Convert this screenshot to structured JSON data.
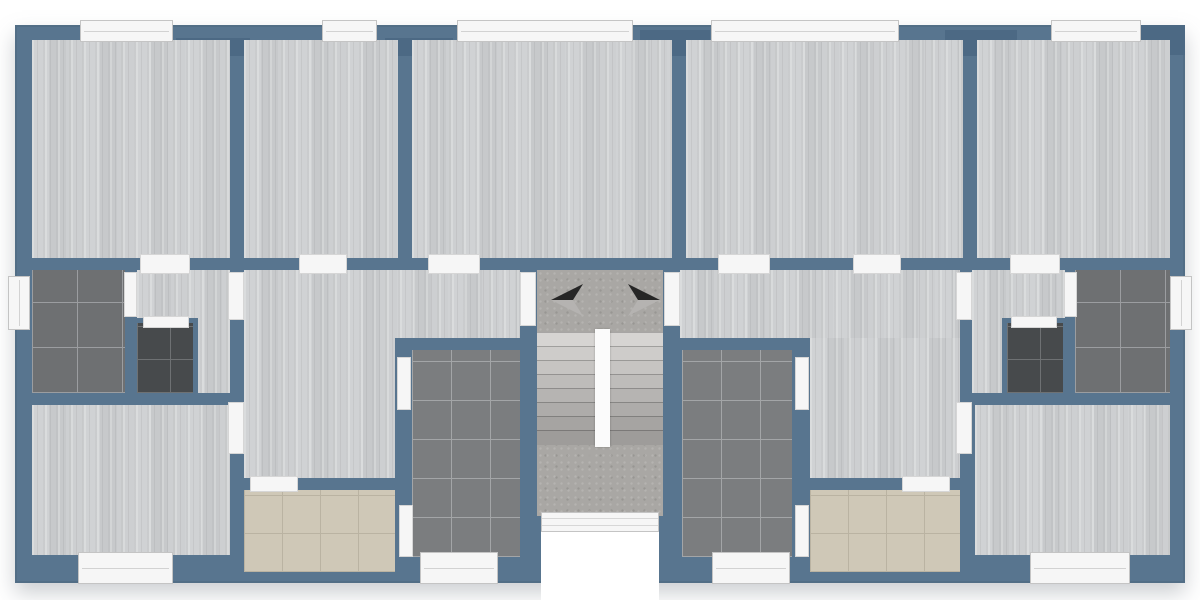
{
  "canvas": {
    "width": 1200,
    "height": 600
  },
  "palette": {
    "outside": "#ffffff",
    "wall": "#58758f",
    "wall_dark": "#4c6984",
    "wood": "#cbcdcf",
    "concrete": "#a9a7a4",
    "tile_gray": "#7b7d7f",
    "tile_gray_grout": "#a3a5a7",
    "tile_gray2": "#6e7072",
    "tile_gray2_grout": "#9b9da0",
    "tile_dark": "#474a4c",
    "tile_dark_grout": "#6e7173",
    "tile_beige": "#cfc8b7",
    "tile_beige_grout": "#bab3a2",
    "fixture": "#f6f6f6",
    "fixture_border": "#c4c4c4",
    "divider": "#fbfbfb",
    "arrow_dark": "#262626",
    "arrow_light": "#b5b3b1"
  },
  "building": {
    "name": "building-outline",
    "x": 15,
    "y": 25,
    "w": 1170,
    "h": 558
  },
  "floors": [
    {
      "name": "room-top-1-floor",
      "type": "wood",
      "x": 32,
      "y": 40,
      "w": 198,
      "h": 218
    },
    {
      "name": "room-top-2-floor",
      "type": "wood",
      "x": 244,
      "y": 40,
      "w": 154,
      "h": 218
    },
    {
      "name": "room-top-3-floor",
      "type": "wood",
      "x": 412,
      "y": 40,
      "w": 260,
      "h": 218
    },
    {
      "name": "room-top-4-floor",
      "type": "wood",
      "x": 686,
      "y": 40,
      "w": 277,
      "h": 218
    },
    {
      "name": "room-top-5-floor",
      "type": "wood",
      "x": 977,
      "y": 40,
      "w": 193,
      "h": 218
    },
    {
      "name": "bathroom-left-floor",
      "type": "tile-gray2",
      "x": 32,
      "y": 270,
      "w": 93,
      "h": 123
    },
    {
      "name": "corridor-left-floor",
      "type": "wood",
      "x": 137,
      "y": 270,
      "w": 93,
      "h": 123
    },
    {
      "name": "wc-left-floor",
      "type": "tile-dark",
      "x": 132,
      "y": 318,
      "w": 66,
      "h": 80
    },
    {
      "name": "room-bottom-left-floor",
      "type": "wood",
      "x": 32,
      "y": 405,
      "w": 198,
      "h": 150
    },
    {
      "name": "hall-left-upper-floor",
      "type": "wood",
      "x": 244,
      "y": 270,
      "w": 276,
      "h": 68
    },
    {
      "name": "hall-left-lower-floor",
      "type": "wood",
      "x": 244,
      "y": 338,
      "w": 151,
      "h": 140
    },
    {
      "name": "kitchen-left-floor",
      "type": "tile-beige",
      "x": 244,
      "y": 490,
      "w": 151,
      "h": 82
    },
    {
      "name": "bathroom-center-left-floor",
      "type": "tile-gray",
      "x": 412,
      "y": 350,
      "w": 108,
      "h": 207
    },
    {
      "name": "stairwell-floor",
      "type": "concrete",
      "x": 537,
      "y": 270,
      "w": 126,
      "h": 246
    },
    {
      "name": "hall-right-upper-floor",
      "type": "wood",
      "x": 680,
      "y": 270,
      "w": 280,
      "h": 68
    },
    {
      "name": "hall-right-lower-floor",
      "type": "wood",
      "x": 810,
      "y": 338,
      "w": 150,
      "h": 140
    },
    {
      "name": "bathroom-center-right-floor",
      "type": "tile-gray",
      "x": 682,
      "y": 350,
      "w": 110,
      "h": 207
    },
    {
      "name": "kitchen-right-floor",
      "type": "tile-beige",
      "x": 810,
      "y": 490,
      "w": 150,
      "h": 82
    },
    {
      "name": "corridor-right-floor",
      "type": "wood",
      "x": 972,
      "y": 270,
      "w": 93,
      "h": 123
    },
    {
      "name": "wc-right-floor",
      "type": "tile-dark",
      "x": 1002,
      "y": 318,
      "w": 66,
      "h": 80
    },
    {
      "name": "bathroom-right-floor",
      "type": "tile-gray2",
      "x": 1075,
      "y": 270,
      "w": 95,
      "h": 123
    },
    {
      "name": "room-bottom-right-floor",
      "type": "wood",
      "x": 975,
      "y": 405,
      "w": 195,
      "h": 150
    }
  ],
  "windows": [
    {
      "name": "window-top-1",
      "orient": "h",
      "x": 80,
      "y": 20,
      "w": 93,
      "h": 22
    },
    {
      "name": "window-top-2",
      "orient": "h",
      "x": 322,
      "y": 20,
      "w": 55,
      "h": 22
    },
    {
      "name": "window-top-3",
      "orient": "h",
      "x": 457,
      "y": 20,
      "w": 176,
      "h": 22
    },
    {
      "name": "window-top-4",
      "orient": "h",
      "x": 711,
      "y": 20,
      "w": 188,
      "h": 22
    },
    {
      "name": "window-top-5",
      "orient": "h",
      "x": 1051,
      "y": 20,
      "w": 90,
      "h": 22
    },
    {
      "name": "window-left-bathroom",
      "orient": "v",
      "x": 8,
      "y": 276,
      "w": 22,
      "h": 54
    },
    {
      "name": "window-right-bathroom",
      "orient": "v",
      "x": 1170,
      "y": 276,
      "w": 22,
      "h": 54
    },
    {
      "name": "window-bottom-room-left",
      "orient": "h",
      "x": 78,
      "y": 552,
      "w": 95,
      "h": 32
    },
    {
      "name": "window-bottom-bath-center-left",
      "orient": "h",
      "x": 420,
      "y": 552,
      "w": 78,
      "h": 32
    },
    {
      "name": "window-bottom-bath-center-right",
      "orient": "h",
      "x": 712,
      "y": 552,
      "w": 78,
      "h": 32
    },
    {
      "name": "window-bottom-room-right",
      "orient": "h",
      "x": 1030,
      "y": 552,
      "w": 100,
      "h": 32
    }
  ],
  "doors": [
    {
      "name": "opening-room-top-1",
      "x": 140,
      "y": 254,
      "w": 50,
      "h": 20
    },
    {
      "name": "opening-room-top-2",
      "x": 299,
      "y": 254,
      "w": 48,
      "h": 20
    },
    {
      "name": "opening-room-top-3",
      "x": 428,
      "y": 254,
      "w": 52,
      "h": 20
    },
    {
      "name": "opening-room-top-4",
      "x": 718,
      "y": 254,
      "w": 52,
      "h": 20
    },
    {
      "name": "opening-room-top-5",
      "x": 853,
      "y": 254,
      "w": 48,
      "h": 20
    },
    {
      "name": "opening-room-top-6",
      "x": 1010,
      "y": 254,
      "w": 50,
      "h": 20
    },
    {
      "name": "door-apartment-left",
      "x": 520,
      "y": 272,
      "w": 16,
      "h": 54
    },
    {
      "name": "door-apartment-right",
      "x": 664,
      "y": 272,
      "w": 16,
      "h": 54
    },
    {
      "name": "door-corridor-left",
      "x": 228,
      "y": 272,
      "w": 16,
      "h": 48
    },
    {
      "name": "door-room-bottom-left",
      "x": 228,
      "y": 402,
      "w": 16,
      "h": 52
    },
    {
      "name": "door-corridor-right",
      "x": 956,
      "y": 272,
      "w": 16,
      "h": 48
    },
    {
      "name": "door-room-bottom-right",
      "x": 956,
      "y": 402,
      "w": 16,
      "h": 52
    },
    {
      "name": "door-bathroom-left",
      "x": 124,
      "y": 272,
      "w": 13,
      "h": 45
    },
    {
      "name": "door-bathroom-right",
      "x": 1064,
      "y": 272,
      "w": 13,
      "h": 45
    },
    {
      "name": "door-wc-left",
      "x": 143,
      "y": 316,
      "w": 46,
      "h": 12
    },
    {
      "name": "door-wc-right",
      "x": 1011,
      "y": 316,
      "w": 46,
      "h": 12
    },
    {
      "name": "door-bath-center-left-top",
      "x": 397,
      "y": 357,
      "w": 14,
      "h": 53
    },
    {
      "name": "door-bath-center-left-bottom",
      "x": 399,
      "y": 505,
      "w": 14,
      "h": 52
    },
    {
      "name": "door-bath-center-right-top",
      "x": 795,
      "y": 357,
      "w": 14,
      "h": 53
    },
    {
      "name": "door-bath-center-right-bottom",
      "x": 795,
      "y": 505,
      "w": 14,
      "h": 52
    },
    {
      "name": "opening-kitchen-left",
      "x": 250,
      "y": 476,
      "w": 48,
      "h": 16
    },
    {
      "name": "opening-kitchen-right",
      "x": 902,
      "y": 476,
      "w": 48,
      "h": 16
    }
  ],
  "entry": {
    "name": "entrance-door",
    "x": 541,
    "y": 512,
    "w": 118,
    "h": 20
  },
  "porch": {
    "name": "entrance-porch",
    "x": 541,
    "y": 532,
    "w": 118,
    "h": 70
  },
  "stairs": {
    "divider": {
      "name": "stair-divider",
      "x": 595,
      "y": 329,
      "w": 15,
      "h": 118
    },
    "flights": [
      {
        "name": "stair-flight-left",
        "x": 537,
        "y": 332,
        "w": 58,
        "treads": 8,
        "tread_h": 14
      },
      {
        "name": "stair-flight-right",
        "x": 610,
        "y": 332,
        "w": 53,
        "treads": 8,
        "tread_h": 14
      }
    ]
  },
  "arrows": [
    {
      "name": "stair-arrow-left-icon",
      "dir": "left",
      "x": 551,
      "y": 282,
      "w": 32,
      "h": 36
    },
    {
      "name": "stair-arrow-right-icon",
      "dir": "right",
      "x": 628,
      "y": 282,
      "w": 32,
      "h": 36
    }
  ],
  "accents": [
    {
      "name": "wall-accent-1",
      "x": 176,
      "y": 38,
      "w": 74,
      "h": 18
    },
    {
      "name": "wall-accent-2",
      "x": 385,
      "y": 38,
      "w": 68,
      "h": 18
    },
    {
      "name": "wall-accent-3",
      "x": 640,
      "y": 30,
      "w": 70,
      "h": 26
    },
    {
      "name": "wall-accent-4",
      "x": 945,
      "y": 30,
      "w": 72,
      "h": 26
    },
    {
      "name": "wall-accent-5",
      "x": 1136,
      "y": 25,
      "w": 49,
      "h": 30
    }
  ]
}
